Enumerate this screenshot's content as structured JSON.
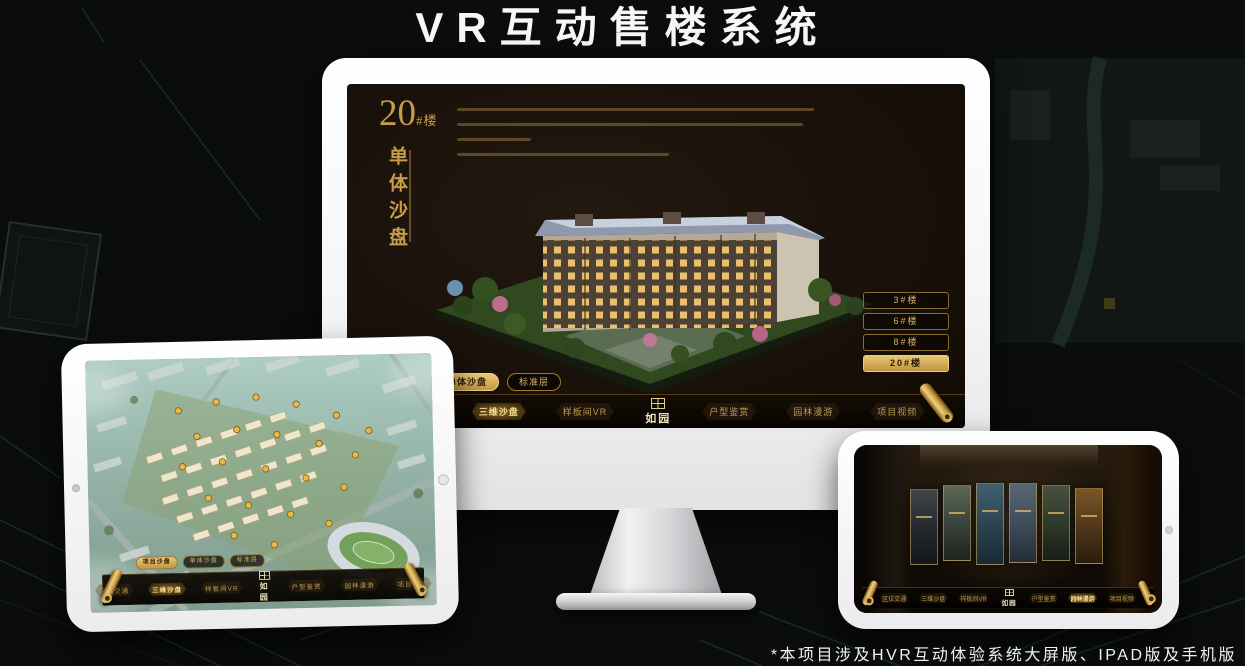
{
  "page": {
    "title": "VR互动售楼系统",
    "footnote": "*本项目涉及HVR互动体验系统大屏版、IPAD版及手机版"
  },
  "brand": {
    "logo": "如园",
    "accent_gold": "#c79d4a",
    "screen_background": "#140d06"
  },
  "monitor_screen": {
    "headline_number": "20",
    "headline_unit": "#楼",
    "headline_vertical": "单体沙盘",
    "floor_buttons": [
      {
        "label": "3#楼",
        "active": false
      },
      {
        "label": "6#楼",
        "active": false
      },
      {
        "label": "8#楼",
        "active": false
      },
      {
        "label": "20#楼",
        "active": true
      }
    ],
    "sub_tabs": [
      {
        "label": "项目沙盘",
        "active": false
      },
      {
        "label": "单体沙盘",
        "active": true
      },
      {
        "label": "标准层",
        "active": false
      }
    ],
    "nav_items": [
      {
        "label": "区位交通",
        "active": false
      },
      {
        "label": "三维沙盘",
        "active": true
      },
      {
        "label": "样板间VR",
        "active": false
      },
      {
        "label": "户型鉴赏",
        "active": false
      },
      {
        "label": "园林漫游",
        "active": false
      },
      {
        "label": "项目视频",
        "active": false
      }
    ]
  },
  "tablet_screen": {
    "sub_tabs": [
      {
        "label": "项目沙盘",
        "active": true
      },
      {
        "label": "单体沙盘",
        "active": false
      },
      {
        "label": "标准层",
        "active": false
      }
    ],
    "nav_items": [
      {
        "label": "区位交通",
        "active": false
      },
      {
        "label": "三维沙盘",
        "active": true
      },
      {
        "label": "样板间VR",
        "active": false
      },
      {
        "label": "户型鉴赏",
        "active": false
      },
      {
        "label": "园林漫游",
        "active": false
      },
      {
        "label": "项目视频",
        "active": false
      }
    ]
  },
  "phone_screen": {
    "nav_items": [
      {
        "label": "区位交通",
        "active": false
      },
      {
        "label": "三维沙盘",
        "active": false
      },
      {
        "label": "样板间VR",
        "active": false
      },
      {
        "label": "户型鉴赏",
        "active": false
      },
      {
        "label": "园林漫游",
        "active": true
      },
      {
        "label": "项目视频",
        "active": false
      }
    ]
  }
}
